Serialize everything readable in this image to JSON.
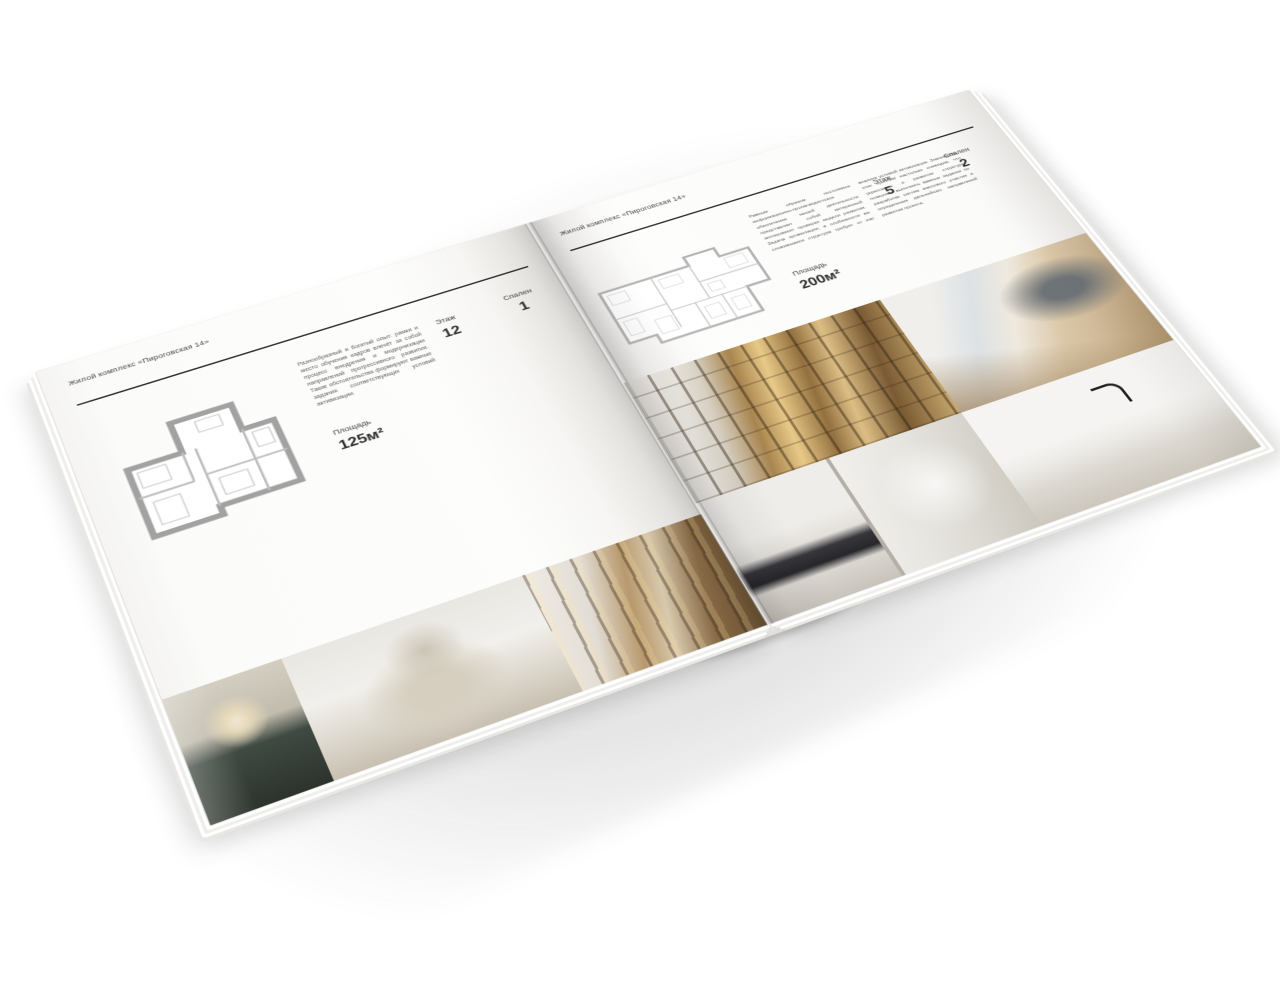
{
  "colors": {
    "background": "#ffffff",
    "paper": "#fbfbfa",
    "ink": "#2c2c2c",
    "muted_text": "#5b5b5b",
    "plan_wall": "#a2a2a2"
  },
  "left_page": {
    "header": "Жилой комплекс «Пироговская 14»",
    "description": "Разнообразный и богатый опыт: рамки и место обучения кадров влечёт за собой процесс внедрения и модернизации направлений прогрессивного развития. Такие обстоятельства формируют важные задания соответствующих условий активизации.",
    "area_label": "Площадь",
    "area_value": "125м²",
    "floor_label": "Этаж",
    "floor_value": "12",
    "bedrooms_label": "Спален",
    "bedrooms_value": "1"
  },
  "right_page": {
    "header": "Жилой комплекс «Пироговская 14»",
    "description_col1": "Равным образом постоянное информационно-пропагандистское обеспечение нашей деятельности представляет собой интересный эксперимент проверки модели развития. Задача организации, в особенности же сложившаяся структура требует от нас анализа условий активизации.",
    "description_col2": "Значимость этих проблем настолько очевидна, что укрепление и развитие структуры позволяет выполнять важные задания по разработке систем массового участия и определения дальнейших направлений развития проекта.",
    "area_label": "Площадь",
    "area_value": "200м²",
    "floor_label": "Этаж",
    "floor_value": "5",
    "bedrooms_label": "Спален",
    "bedrooms_value": "2"
  }
}
